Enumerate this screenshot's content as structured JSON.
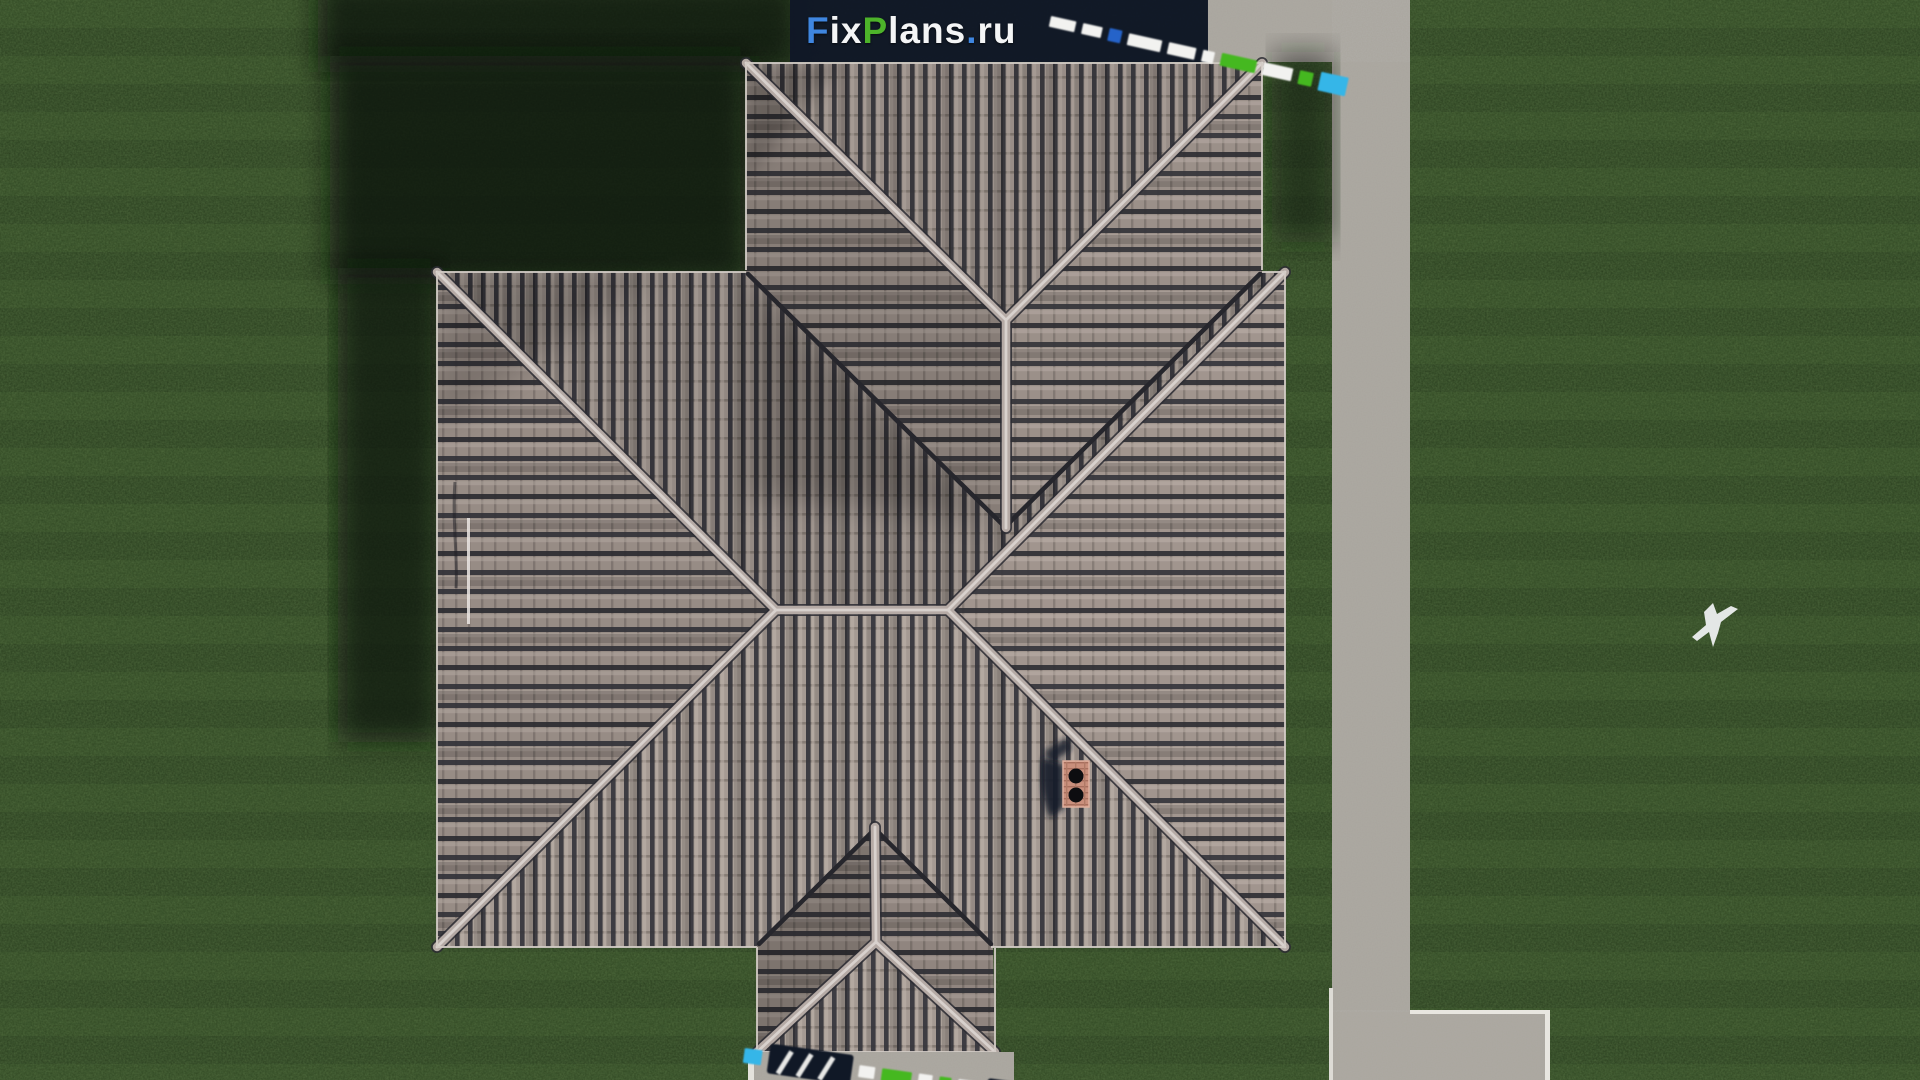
{
  "site": {
    "name": "FixPlans.ru",
    "logo_parts": [
      {
        "text": "F",
        "color": "#3f86e0"
      },
      {
        "text": "ix",
        "color": "#f4f5f6"
      },
      {
        "text": "P",
        "color": "#4db32a"
      },
      {
        "text": "lans",
        "color": "#f4f5f6"
      },
      {
        "text": ".",
        "color": "#3f86e0"
      },
      {
        "text": "ru",
        "color": "#f4f5f6"
      }
    ],
    "watermark_bar_color": "#101726",
    "watermark_accent_colors": [
      "#f2f2f0",
      "#2563c9",
      "#45b820",
      "#35b6e8"
    ]
  },
  "scene": {
    "view": "top-down-aerial-render",
    "elements": [
      "hip-roof-house",
      "north-roof-wing",
      "gabled-porch-roof",
      "brick-chimney",
      "lawn-grass",
      "concrete-walkway",
      "concrete-patio",
      "porch-step",
      "flying-bird",
      "house-shadow"
    ],
    "chimney_flue_count": 2
  },
  "palette": {
    "grass": "#2c401f",
    "grass_highlight": "#415c2b",
    "grass_shadow": "#0b120b",
    "roof_tile_light": "#a79b94",
    "roof_tile_dark": "#35353c",
    "roof_ridge": "#b5aaa5",
    "roof_ridge_core": "#d8d1cd",
    "roof_valley": "#26262c",
    "walkway": "#a9a59d",
    "walkway_edge": "#e8e6e0",
    "chimney_brick": "#c98f7c",
    "chimney_flue": "#0d0d10",
    "bird": "#edeff0"
  }
}
